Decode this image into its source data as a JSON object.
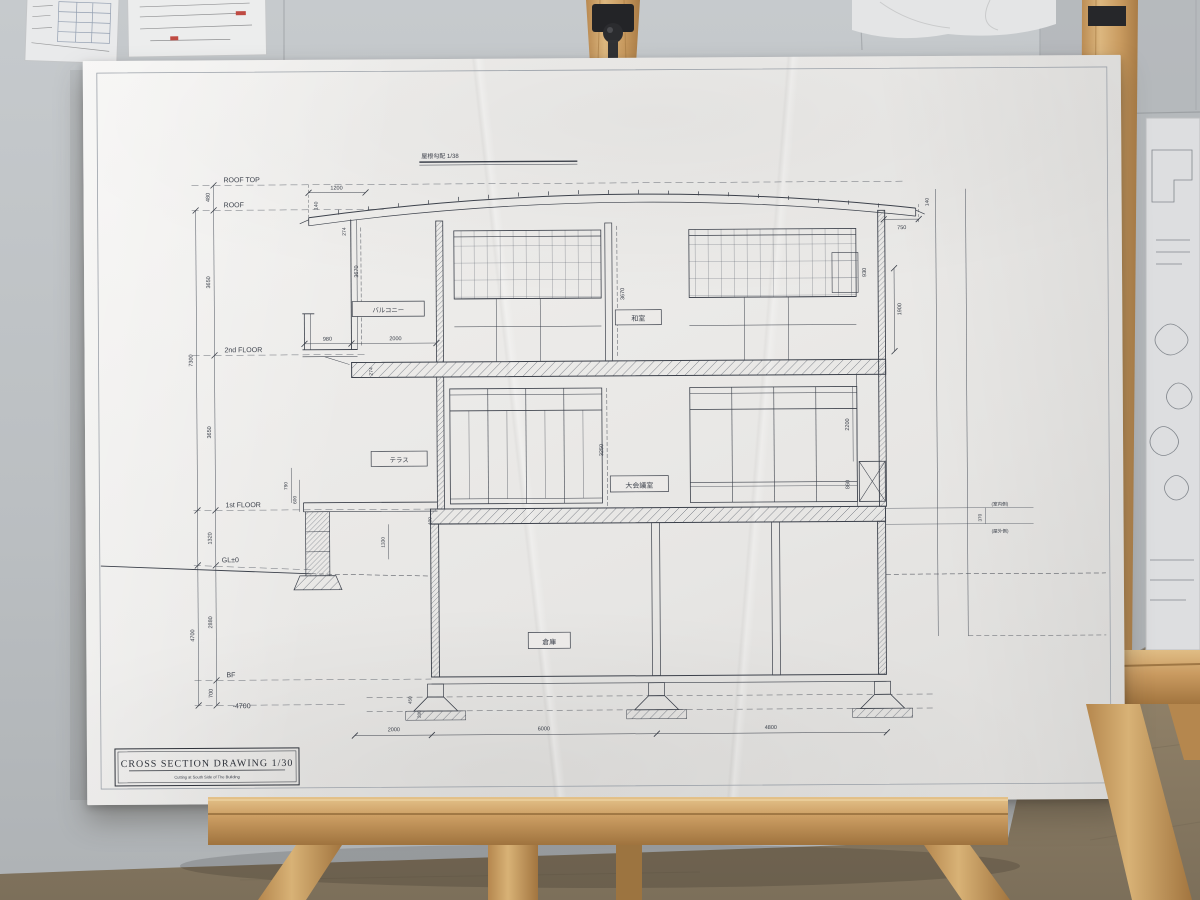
{
  "title_block": {
    "title": "CROSS SECTION DRAWING 1/30",
    "subtitle": "Cutting at South Side of The Building"
  },
  "roof_note": "屋根勾配 1/38",
  "levels": {
    "roof_top": "ROOF TOP",
    "roof": "ROOF",
    "fl2": "2nd FLOOR",
    "fl1": "1st FLOOR",
    "gl": "GL±0",
    "bf": "BF"
  },
  "rooms": {
    "balcony": "バルコニー",
    "washitsu": "和室",
    "terrace": "テラス",
    "meeting": "大会議室",
    "storage": "倉庫"
  },
  "side_notes": {
    "inner": "(室内側)",
    "outer": "(屋外側)"
  },
  "dims": {
    "d480": "480",
    "d3650a": "3650",
    "d3650b": "3650",
    "d7300": "7300",
    "d1320": "1320",
    "d2880": "2880",
    "d4700": "4700",
    "d700": "700",
    "dm4700": "-4700",
    "d1200": "1200",
    "d140a": "140",
    "d274a": "274",
    "d274b": "274",
    "d750": "750",
    "d140b": "140",
    "d930": "930",
    "d1900": "1900",
    "d2200": "2200",
    "d860": "860",
    "d370": "370",
    "d980": "980",
    "d2000a": "2000",
    "d3670a": "3670",
    "d3670b": "3670",
    "d3250": "3250",
    "d790": "790",
    "d600": "600",
    "d400": "400",
    "d1330": "1330",
    "d450": "450",
    "d200": "200",
    "d2000b": "2000",
    "d6000": "6000",
    "d4800": "4800"
  },
  "colors": {
    "wall": "#bfc3c6",
    "carpet": "#8d7e66",
    "wood": "#c99a60",
    "board": "#eceae8",
    "ink": "#3c414b"
  }
}
